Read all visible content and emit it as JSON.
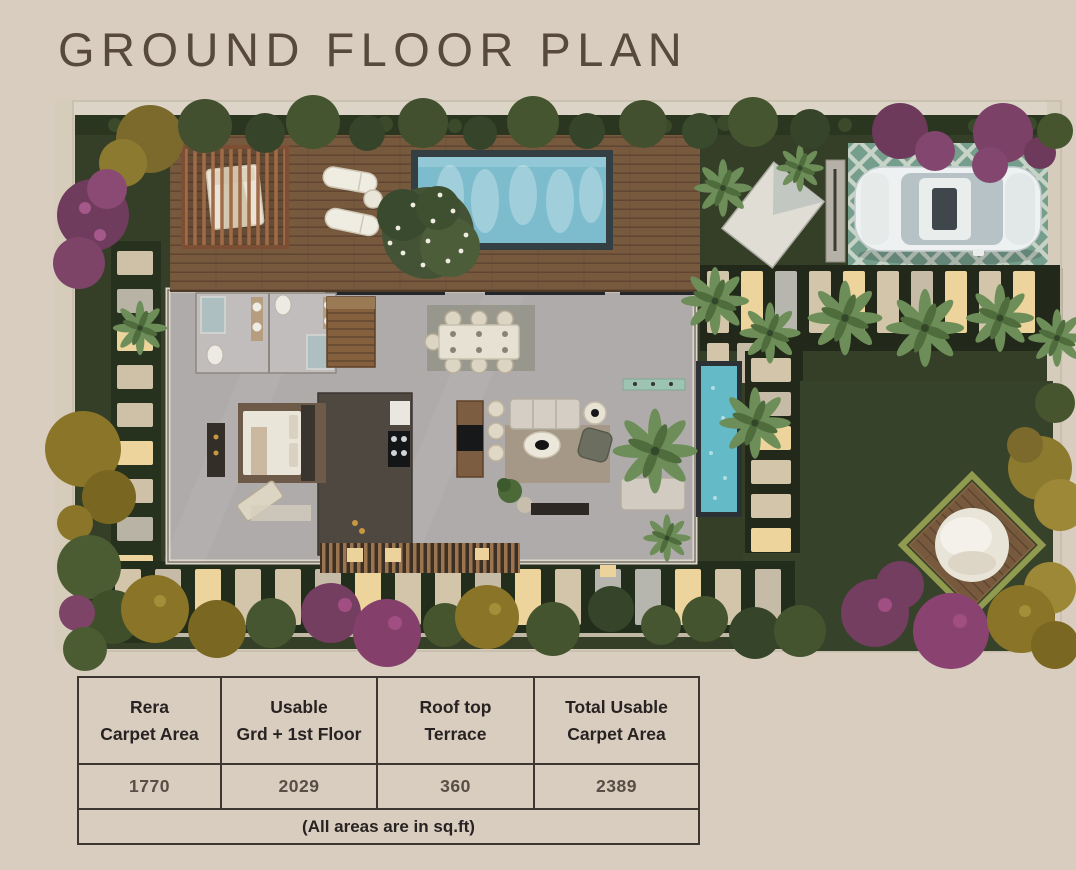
{
  "title": "GROUND FLOOR PLAN",
  "palette": {
    "page_background": "#d9cdbf",
    "title_text": "#57493e",
    "table_border": "#3e3630",
    "table_header_text": "#282322",
    "table_value_text": "#584e46",
    "pool_water": "#7cbccd",
    "pond_water": "#64bac6",
    "lawn_green": "#37422a",
    "deck_wood": "#77593e",
    "driveway_tile": "#5f8f7b",
    "car_body": "#eef1f1",
    "paver_stone": "#d3c5a9",
    "lit_paver": "#ecd49c",
    "daybed_glow": "#dce66f",
    "shrub_purple": "#743e61",
    "shrub_olive": "#8a7428",
    "foliage_green": "#42502f"
  },
  "table": {
    "columns": [
      {
        "header_line1": "Rera",
        "header_line2": "Carpet Area",
        "value": "1770"
      },
      {
        "header_line1": "Usable",
        "header_line2": "Grd + 1st Floor",
        "value": "2029"
      },
      {
        "header_line1": "Roof top",
        "header_line2": "Terrace",
        "value": "360"
      },
      {
        "header_line1": "Total Usable",
        "header_line2": "Carpet Area",
        "value": "2389"
      }
    ],
    "footnote": "(All areas are in sq.ft)"
  }
}
